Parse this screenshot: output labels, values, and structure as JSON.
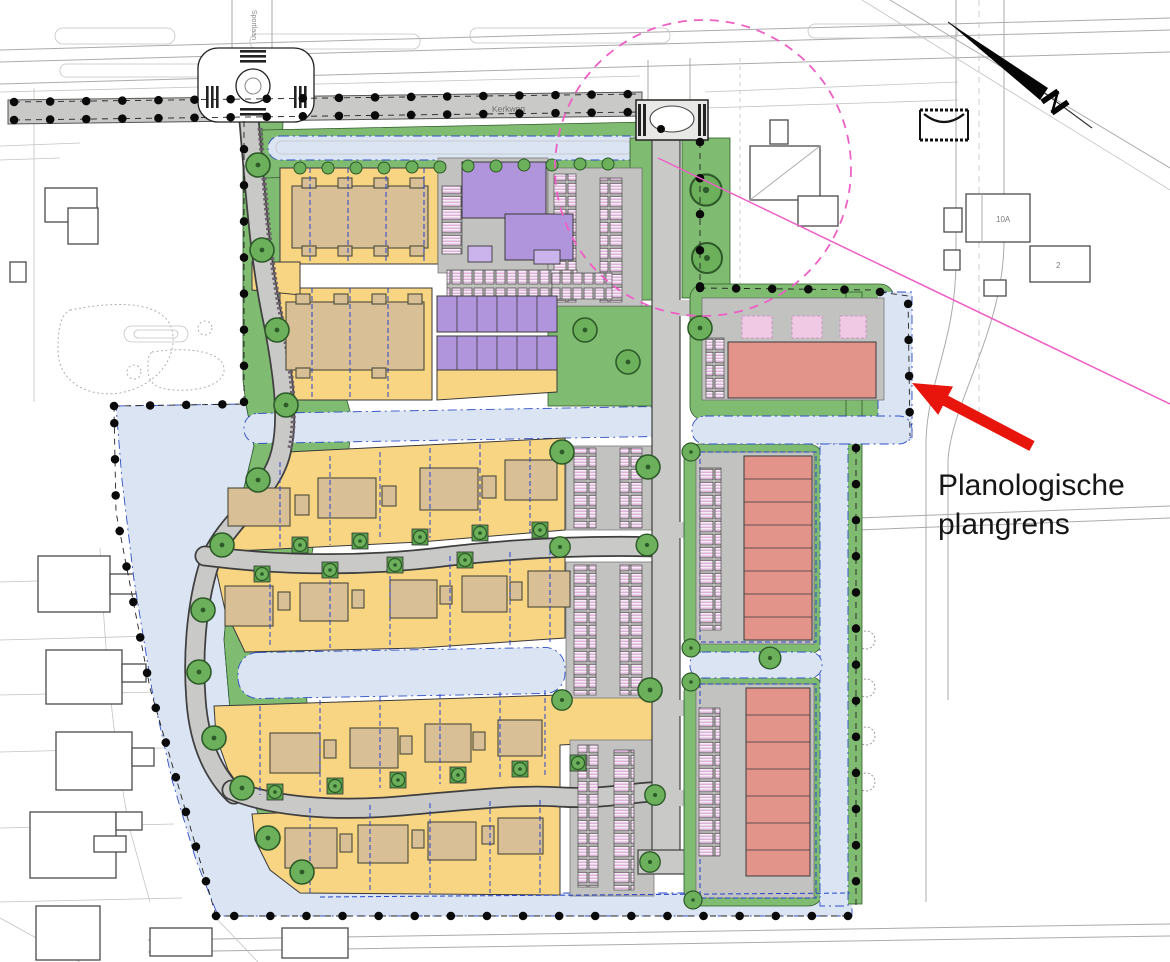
{
  "annotation": {
    "line1": "Planologische",
    "line2": "plangrens",
    "arrow_color": "#e8150d",
    "text_color": "#161616"
  },
  "labels": {
    "road_top": "Kerkweg",
    "road_left": "Sportlaan",
    "house_right": "10A",
    "house_right_2": "2"
  },
  "boundary": {
    "name": "Planologische plangrens",
    "style": "black dotted line",
    "color": "#0a0a0a"
  },
  "overlay": {
    "study_circle_color": "#ee5fc6",
    "study_circle_style": "dashed"
  },
  "north_arrow": "points upper-left",
  "palette": {
    "residential_plots_yellow": "#f8d583",
    "dwellings_tan": "#d8bf96",
    "apartments_purple": "#b195dc",
    "apartments_purple_light": "#cbb4ec",
    "row_houses_salmon": "#e2948a",
    "parking_space_pink": "#d49fcf",
    "water_blue": "#dbe4f3",
    "green_areas": "#80bb72",
    "tree_green": "#6cb05c",
    "road_gray": "#c9c9c7",
    "plot_line_blue": "#2743c9",
    "context_line_gray": "#ababab"
  }
}
